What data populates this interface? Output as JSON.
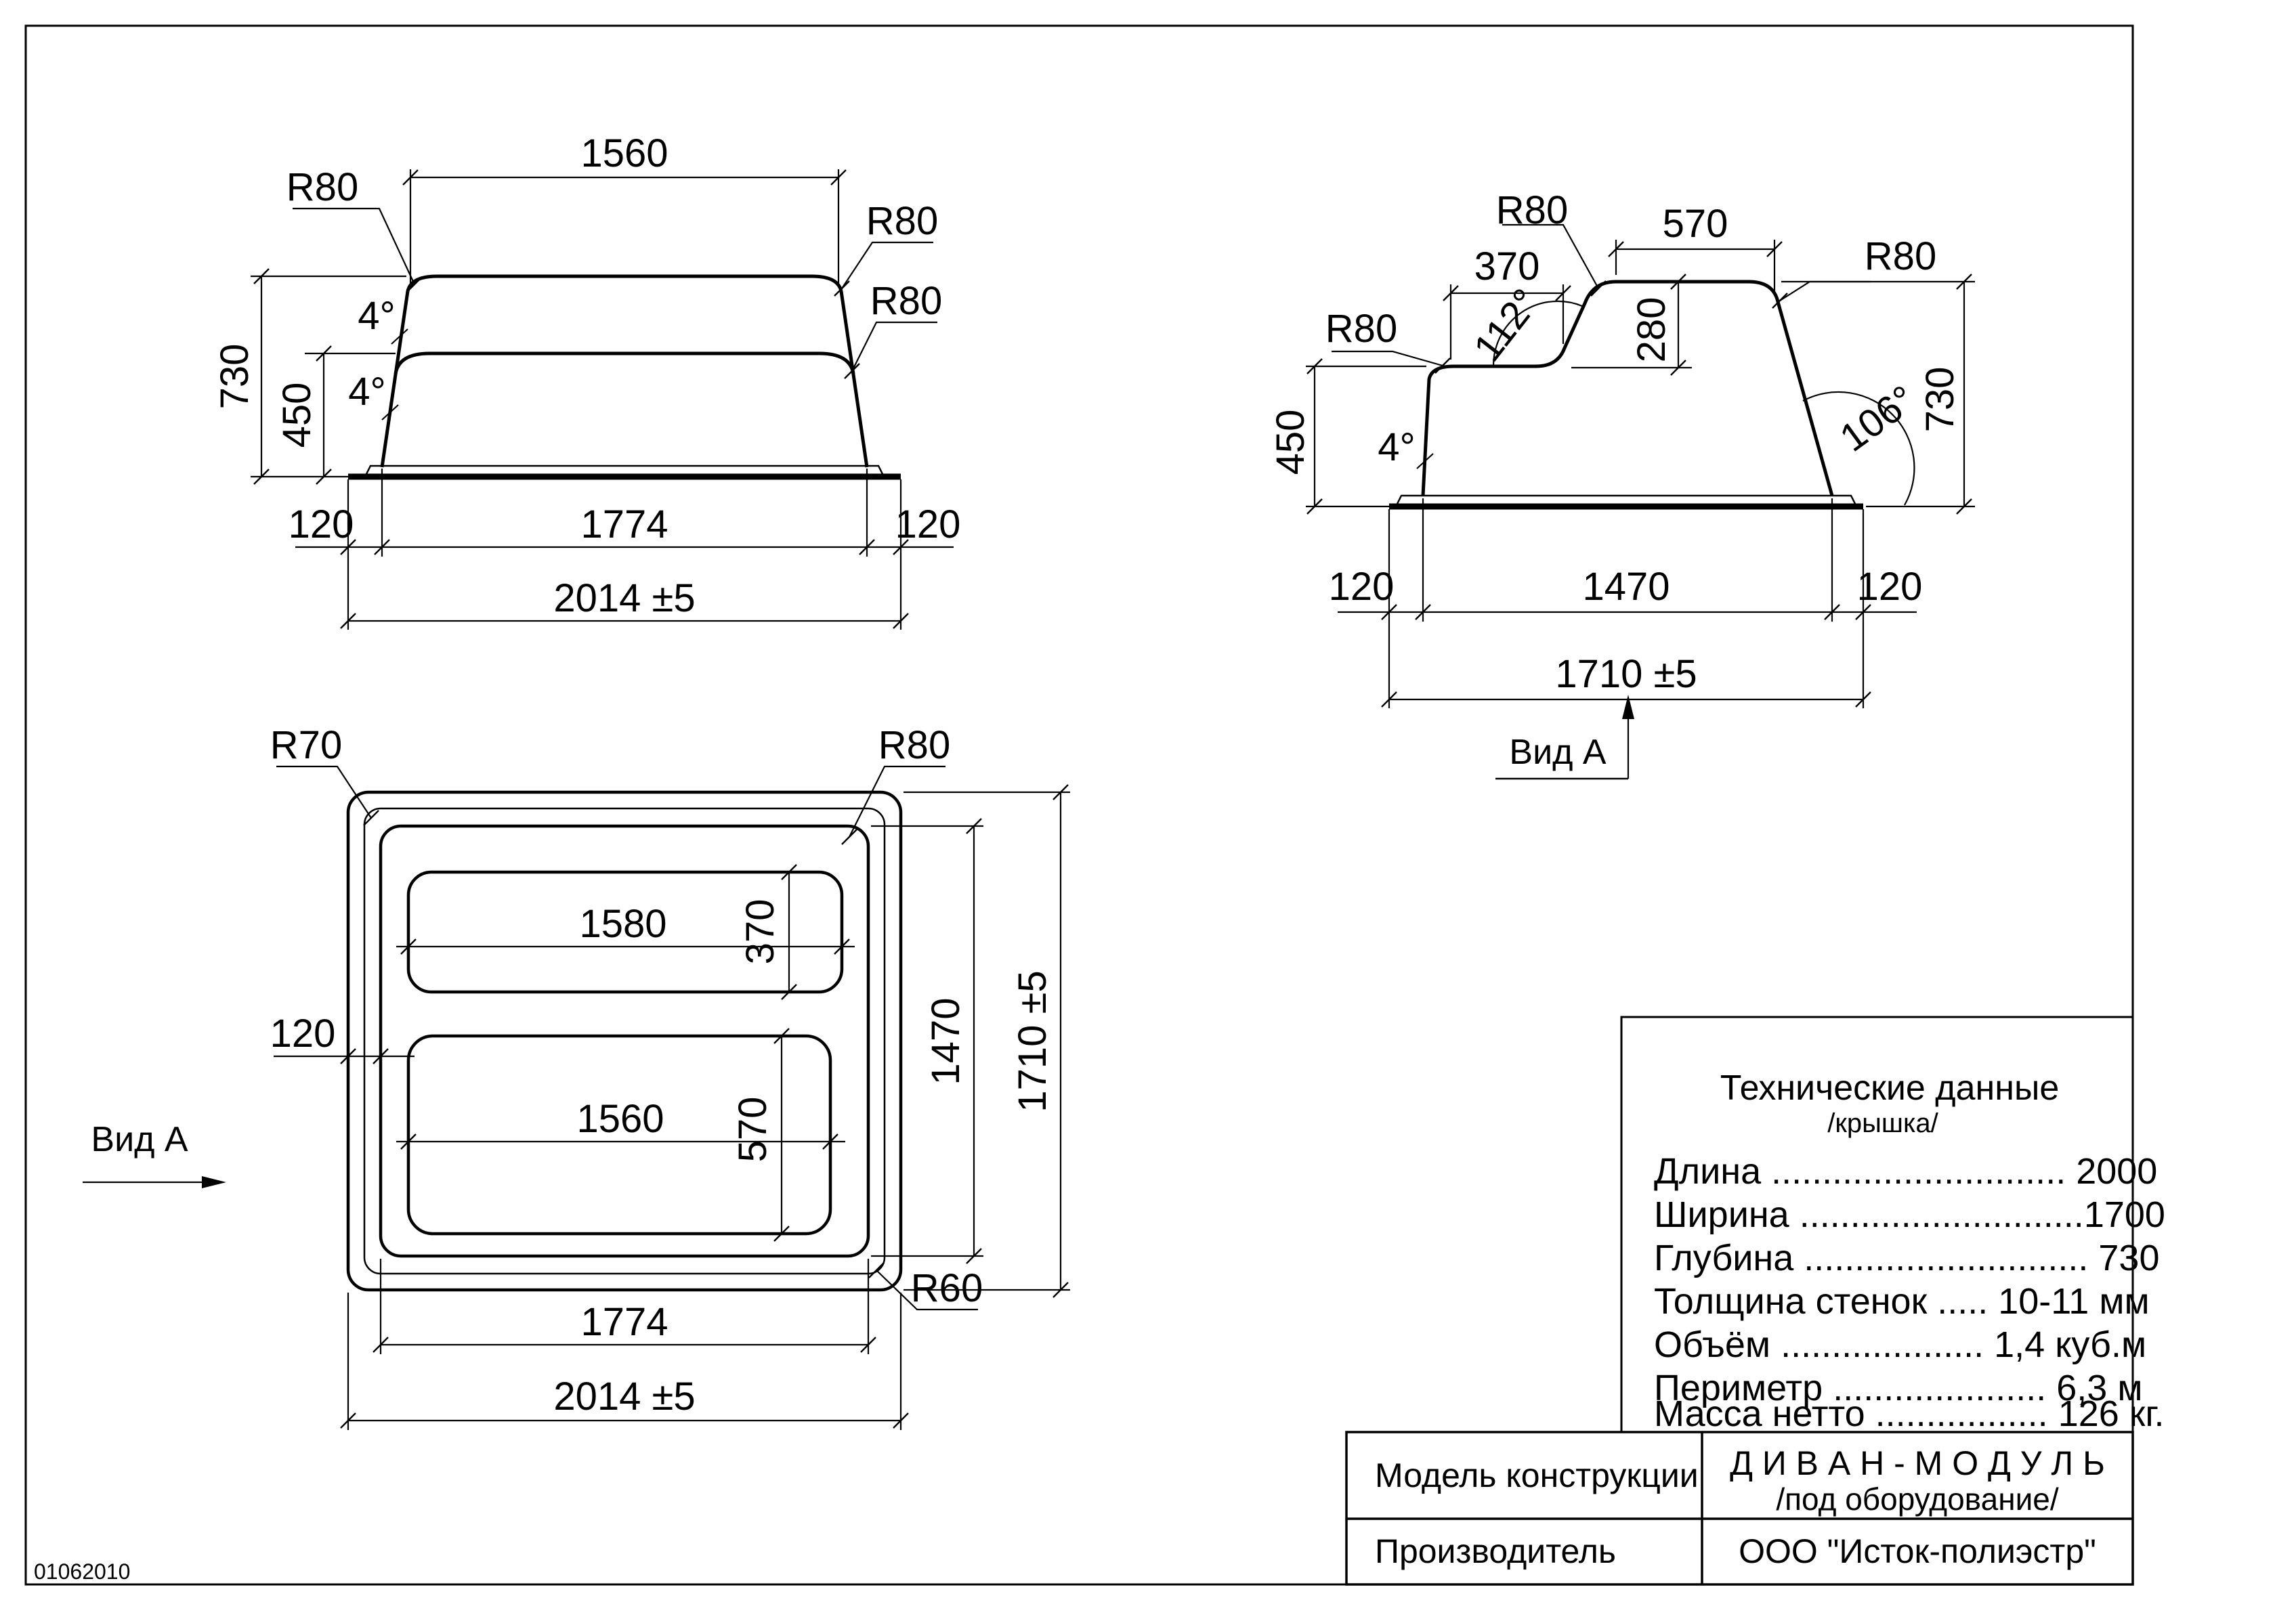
{
  "drawing": {
    "code": "01062010"
  },
  "front_view": {
    "dim_top": "1560",
    "radius_top_left": "R80",
    "radius_top_right": "R80",
    "radius_mid_right": "R80",
    "angle_upper": "4°",
    "angle_lower": "4°",
    "dim_height_total": "730",
    "dim_height_lower": "450",
    "dim_flange_left": "120",
    "dim_body_width": "1774",
    "dim_flange_right": "120",
    "dim_overall_width": "2014 ±5"
  },
  "side_view": {
    "radius_top": "R80",
    "dim_top": "570",
    "radius_right": "R80",
    "dim_seat": "370",
    "radius_seat": "R80",
    "angle_back": "112°",
    "dim_back_height": "280",
    "angle_wall": "4°",
    "angle_front": "106°",
    "dim_height_total": "730",
    "dim_height_lower": "450",
    "dim_flange_left": "120",
    "dim_body_width": "1470",
    "dim_flange_right": "120",
    "dim_overall_width": "1710 ±5",
    "view_label": "Вид А"
  },
  "plan_view": {
    "radius_outer": "R70",
    "radius_inner": "R80",
    "radius_mid": "R60",
    "slot_top_width": "1580",
    "slot_top_height": "370",
    "slot_bottom_width": "1560",
    "slot_bottom_height": "570",
    "dim_flange": "120",
    "dim_inner_height": "1470",
    "dim_overall_height": "1710 ±5",
    "dim_body_width": "1774",
    "dim_overall_width": "2014 ±5",
    "view_label": "Вид А"
  },
  "tech_box": {
    "title": "Технические данные",
    "subtitle": "/крышка/",
    "rows": [
      {
        "label": "Длина ",
        "dots": ".............................",
        "value": " 2000"
      },
      {
        "label": "Ширина ",
        "dots": "............................",
        "value": "1700"
      },
      {
        "label": "Глубина ",
        "dots": "............................",
        "value": " 730"
      },
      {
        "label": "Толщина стенок ",
        "dots": ".....",
        "value": " 10-11 мм"
      },
      {
        "label": "Объём ",
        "dots": "....................",
        "value": " 1,4 куб.м"
      },
      {
        "label": "Периметр ",
        "dots": ".....................",
        "value": " 6,3 м"
      },
      {
        "label": "Масса нетто ",
        "dots": ".................",
        "value": " 126 кг."
      }
    ]
  },
  "title_block": {
    "model_label": "Модель конструкции",
    "model_name": "Д И В А Н - М О Д У Л Ь",
    "model_note": "/под оборудование/",
    "manufacturer_label": "Производитель",
    "manufacturer_value": "ООО \"Исток-полиэстр\""
  }
}
